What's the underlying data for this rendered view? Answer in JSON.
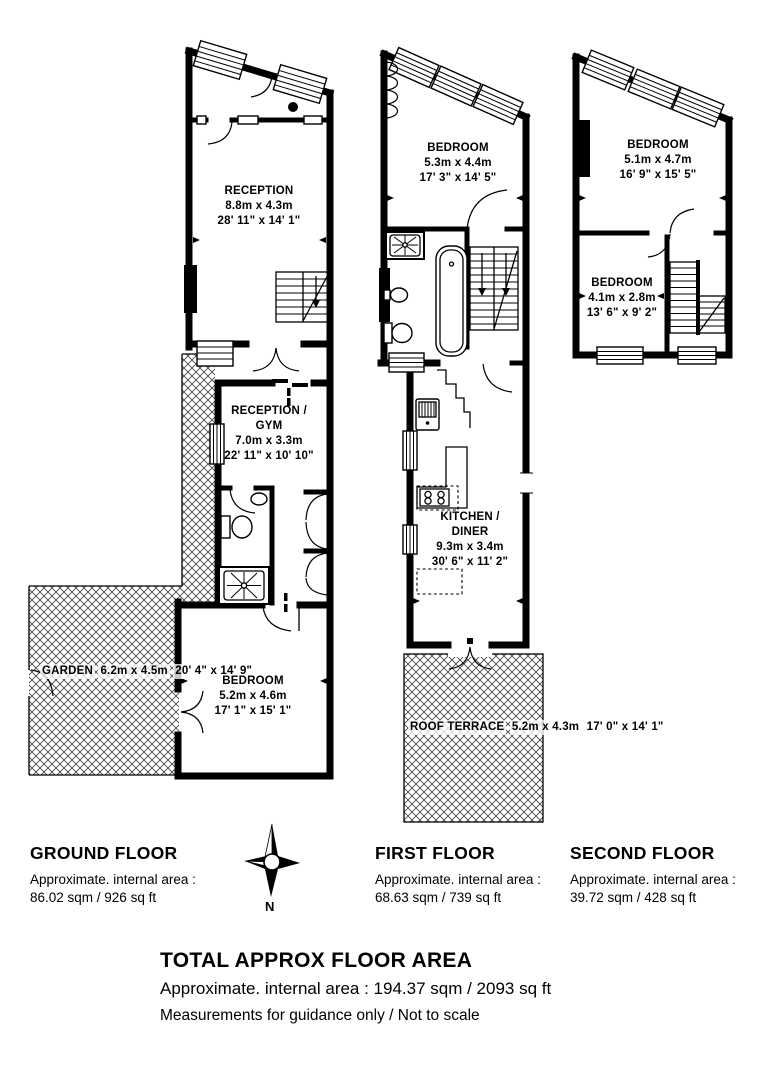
{
  "floors": {
    "ground": {
      "label": "GROUND FLOOR",
      "area_label": "Approximate. internal area :",
      "area_value": "86.02 sqm / 926 sq ft",
      "rooms": {
        "reception": {
          "name": "RECEPTION",
          "metric": "8.8m x 4.3m",
          "imperial": "28' 11\" x 14' 1\""
        },
        "reception_gym": {
          "name_line1": "RECEPTION /",
          "name_line2": "GYM",
          "metric": "7.0m x 3.3m",
          "imperial": "22' 11\" x 10' 10\""
        },
        "garden": {
          "name": "GARDEN",
          "metric": "6.2m x 4.5m",
          "imperial": "20' 4\" x 14' 9\""
        },
        "bedroom": {
          "name": "BEDROOM",
          "metric": "5.2m x 4.6m",
          "imperial": "17' 1\" x 15' 1\""
        }
      }
    },
    "first": {
      "label": "FIRST FLOOR",
      "area_label": "Approximate. internal area :",
      "area_value": "68.63 sqm / 739 sq ft",
      "rooms": {
        "bedroom": {
          "name": "BEDROOM",
          "metric": "5.3m x 4.4m",
          "imperial": "17' 3\" x 14' 5\""
        },
        "kitchen_diner": {
          "name_line1": "KITCHEN /",
          "name_line2": "DINER",
          "metric": "9.3m x 3.4m",
          "imperial": "30' 6\" x 11' 2\""
        },
        "roof_terrace": {
          "name": "ROOF TERRACE",
          "metric": "5.2m x 4.3m",
          "imperial": "17' 0\" x 14' 1\""
        }
      }
    },
    "second": {
      "label": "SECOND FLOOR",
      "area_label": "Approximate. internal area :",
      "area_value": "39.72 sqm / 428 sq ft",
      "rooms": {
        "bedroom_front": {
          "name": "BEDROOM",
          "metric": "5.1m x 4.7m",
          "imperial": "16' 9\" x 15' 5\""
        },
        "bedroom_back": {
          "name": "BEDROOM",
          "metric": "4.1m x 2.8m",
          "imperial": "13' 6\" x 9' 2\""
        }
      }
    }
  },
  "compass": {
    "north_label": "N"
  },
  "total": {
    "title": "TOTAL APPROX FLOOR AREA",
    "area_line": "Approximate. internal area : 194.37 sqm / 2093 sq ft",
    "disclaimer": "Measurements for guidance only / Not to scale"
  },
  "colors": {
    "ink": "#000000",
    "background": "#ffffff",
    "hatch_line": "#3f3f3f"
  }
}
